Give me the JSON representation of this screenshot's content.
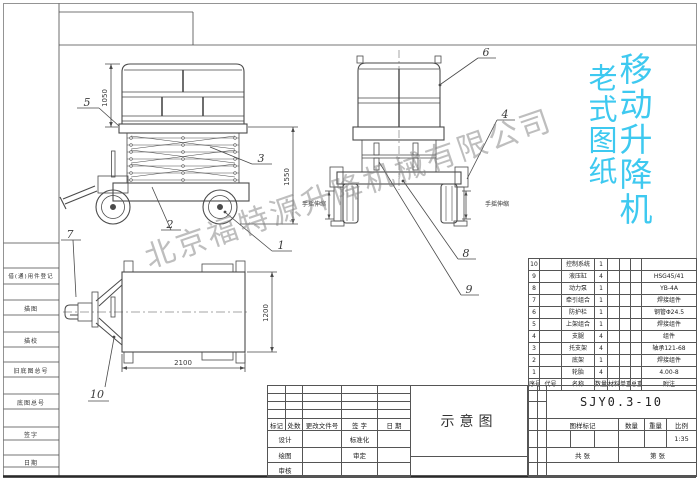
{
  "stamp": {
    "col_right": "移动升降机",
    "col_left": "老式图纸",
    "color": "#3ec9f0"
  },
  "watermark": {
    "text": "北京福特源升降机械有限公司"
  },
  "left_strip": {
    "labels": [
      "借(通)用件登记",
      "描图",
      "描校",
      "旧底图总号",
      "底图总号",
      "签字",
      "日期"
    ]
  },
  "balloons": {
    "b1": "1",
    "b2": "2",
    "b3": "3",
    "b4": "4",
    "b5": "5",
    "b6": "6",
    "b7": "7",
    "b8": "8",
    "b9": "9",
    "b10": "10"
  },
  "dims": {
    "front_rail": "1050",
    "front_total": "1550",
    "top_width": "2100",
    "top_depth": "1200"
  },
  "side_view": {
    "label_left": "手摇伸缩",
    "label_right": "手摇伸缩"
  },
  "parts_table": {
    "headers": [
      "序号",
      "代号",
      "名称",
      "数量",
      "材料",
      "单重",
      "总重",
      "附注"
    ],
    "rows": [
      {
        "no": "10",
        "code": "",
        "name": "控制系统",
        "qty": "1",
        "material": "",
        "unit_w": "",
        "total_w": "",
        "note": ""
      },
      {
        "no": "9",
        "code": "",
        "name": "液压缸",
        "qty": "4",
        "material": "",
        "unit_w": "",
        "total_w": "",
        "note": "HSG45/41"
      },
      {
        "no": "8",
        "code": "",
        "name": "动力泵",
        "qty": "1",
        "material": "",
        "unit_w": "",
        "total_w": "",
        "note": "YB-4A"
      },
      {
        "no": "7",
        "code": "",
        "name": "牵引组合",
        "qty": "1",
        "material": "",
        "unit_w": "",
        "total_w": "",
        "note": "焊接组件"
      },
      {
        "no": "6",
        "code": "",
        "name": "防护栏",
        "qty": "1",
        "material": "",
        "unit_w": "",
        "total_w": "",
        "note": "钢管Φ24.5"
      },
      {
        "no": "5",
        "code": "",
        "name": "上架组合",
        "qty": "1",
        "material": "",
        "unit_w": "",
        "total_w": "",
        "note": "焊接组件"
      },
      {
        "no": "4",
        "code": "",
        "name": "支腿",
        "qty": "4",
        "material": "",
        "unit_w": "",
        "total_w": "",
        "note": "组件"
      },
      {
        "no": "3",
        "code": "",
        "name": "托支架",
        "qty": "4",
        "material": "",
        "unit_w": "",
        "total_w": "",
        "note": "轴承121-68"
      },
      {
        "no": "2",
        "code": "",
        "name": "底架",
        "qty": "1",
        "material": "",
        "unit_w": "",
        "total_w": "",
        "note": "焊接组件"
      },
      {
        "no": "1",
        "code": "",
        "name": "轮胎",
        "qty": "4",
        "material": "",
        "unit_w": "",
        "total_w": "",
        "note": "4.00-8"
      }
    ]
  },
  "revision_block": {
    "headers": [
      "标记",
      "处数",
      "更改文件号",
      "签 字",
      "日 期"
    ],
    "rows": [
      {
        "l": "设计",
        "r": "标准化"
      },
      {
        "l": "绘图",
        "r": "审定"
      },
      {
        "l": "审核",
        "r": ""
      }
    ]
  },
  "drawing_title": {
    "name": "示意图"
  },
  "title_block": {
    "model": "SJY0.3-10",
    "labels": [
      "图样标记",
      "数量",
      "重量",
      "比例"
    ],
    "scale": "1:35",
    "sheet_left": "共  张",
    "sheet_right": "第  张"
  }
}
